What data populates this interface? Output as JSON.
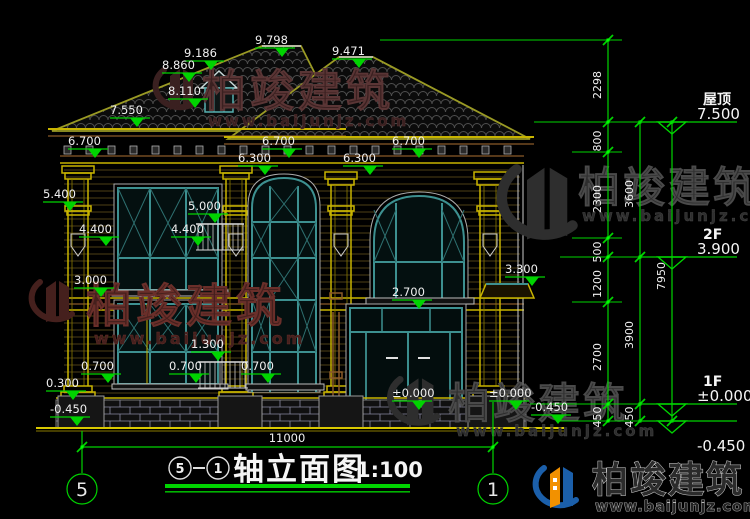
{
  "watermark": {
    "brand": "柏竣建筑",
    "url": "www.baijunjz.com"
  },
  "title_block": {
    "axis_from": "5",
    "axis_to": "1",
    "title": "轴立面图",
    "scale": "1:100",
    "dash": "—"
  },
  "axis_bubbles": [
    {
      "label": "5",
      "x": 82,
      "y": 489
    },
    {
      "label": "1",
      "x": 493,
      "y": 489
    }
  ],
  "bottom_dimension": {
    "text": "11000",
    "x1": 82,
    "x2": 493,
    "y": 447
  },
  "levels_right": [
    {
      "name": "屋顶",
      "value": "7.500",
      "y": 122,
      "below": false
    },
    {
      "name": "2F",
      "value": "3.900",
      "y": 257,
      "below": false
    },
    {
      "name": "1F",
      "value": "±0.000",
      "y": 404,
      "below": false
    },
    {
      "name": "",
      "value": "-0.450",
      "y": 421,
      "below": true
    }
  ],
  "elevation_markers": [
    {
      "label": "9.798",
      "x": 283,
      "y": 57
    },
    {
      "label": "9.471",
      "x": 360,
      "y": 68
    },
    {
      "label": "9.186",
      "x": 212,
      "y": 70
    },
    {
      "label": "8.860",
      "x": 190,
      "y": 82
    },
    {
      "label": "8.110",
      "x": 196,
      "y": 108
    },
    {
      "label": "7.550",
      "x": 138,
      "y": 127
    },
    {
      "label": "6.700",
      "x": 96,
      "y": 158
    },
    {
      "label": "6.700",
      "x": 290,
      "y": 158
    },
    {
      "label": "6.700",
      "x": 420,
      "y": 158
    },
    {
      "label": "6.300",
      "x": 266,
      "y": 175
    },
    {
      "label": "6.300",
      "x": 371,
      "y": 175
    },
    {
      "label": "5.400",
      "x": 71,
      "y": 211
    },
    {
      "label": "5.000",
      "x": 216,
      "y": 223
    },
    {
      "label": "4.400",
      "x": 107,
      "y": 246
    },
    {
      "label": "4.400",
      "x": 199,
      "y": 246
    },
    {
      "label": "3.300",
      "x": 533,
      "y": 286
    },
    {
      "label": "3.000",
      "x": 102,
      "y": 297
    },
    {
      "label": "2.700",
      "x": 420,
      "y": 309
    },
    {
      "label": "1.300",
      "x": 219,
      "y": 361
    },
    {
      "label": "0.700",
      "x": 109,
      "y": 383
    },
    {
      "label": "0.700",
      "x": 197,
      "y": 383
    },
    {
      "label": "0.700",
      "x": 269,
      "y": 383
    },
    {
      "label": "0.300",
      "x": 74,
      "y": 400
    },
    {
      "label": "±0.000",
      "x": 420,
      "y": 410
    },
    {
      "label": "±0.000",
      "x": 517,
      "y": 410
    },
    {
      "label": "-0.450",
      "x": 78,
      "y": 426
    },
    {
      "label": "-0.450",
      "x": 559,
      "y": 424
    }
  ],
  "right_chains": [
    {
      "x": 608,
      "y1": 40,
      "y2": 421,
      "ticks": [
        40,
        122,
        152,
        238,
        257,
        302,
        404,
        421
      ],
      "labels": [
        {
          "t": "2298",
          "y": 81
        },
        {
          "t": "800",
          "y": 137
        },
        {
          "t": "2300",
          "y": 195
        },
        {
          "t": "500",
          "y": 248
        },
        {
          "t": "1200",
          "y": 280
        },
        {
          "t": "2700",
          "y": 353
        },
        {
          "t": "450",
          "y": 413
        }
      ]
    },
    {
      "x": 640,
      "y1": 122,
      "y2": 421,
      "ticks": [
        122,
        257,
        404,
        421
      ],
      "labels": [
        {
          "t": "3600",
          "y": 190
        },
        {
          "t": "3900",
          "y": 331
        },
        {
          "t": "450",
          "y": 413
        }
      ]
    },
    {
      "x": 672,
      "y1": 122,
      "y2": 421,
      "ticks": [
        122,
        421
      ],
      "labels": [
        {
          "t": "7950",
          "y": 272
        }
      ]
    }
  ],
  "ext_lines": [
    {
      "y": 40,
      "x1": 380,
      "x2": 622
    },
    {
      "y": 122,
      "x1": 534,
      "x2": 737
    },
    {
      "y": 152,
      "x1": 572,
      "x2": 622
    },
    {
      "y": 238,
      "x1": 572,
      "x2": 622
    },
    {
      "y": 257,
      "x1": 560,
      "x2": 690
    },
    {
      "y": 302,
      "x1": 572,
      "x2": 622
    },
    {
      "y": 404,
      "x1": 530,
      "x2": 737
    },
    {
      "y": 421,
      "x1": 560,
      "x2": 737
    }
  ],
  "colors": {
    "annotation_green": "#00d400",
    "text_white": "#f0f0f0",
    "frame_teal": "#3d9090",
    "trim_yellow": "#c8b400",
    "cornice_brown": "#8a5a28",
    "brick_gray": "#8888a0",
    "watermark_red": "#45201d",
    "watermark_gray": "#2e2e2e",
    "logo_blue": "#1b5faa",
    "logo_orange": "#f29100"
  }
}
